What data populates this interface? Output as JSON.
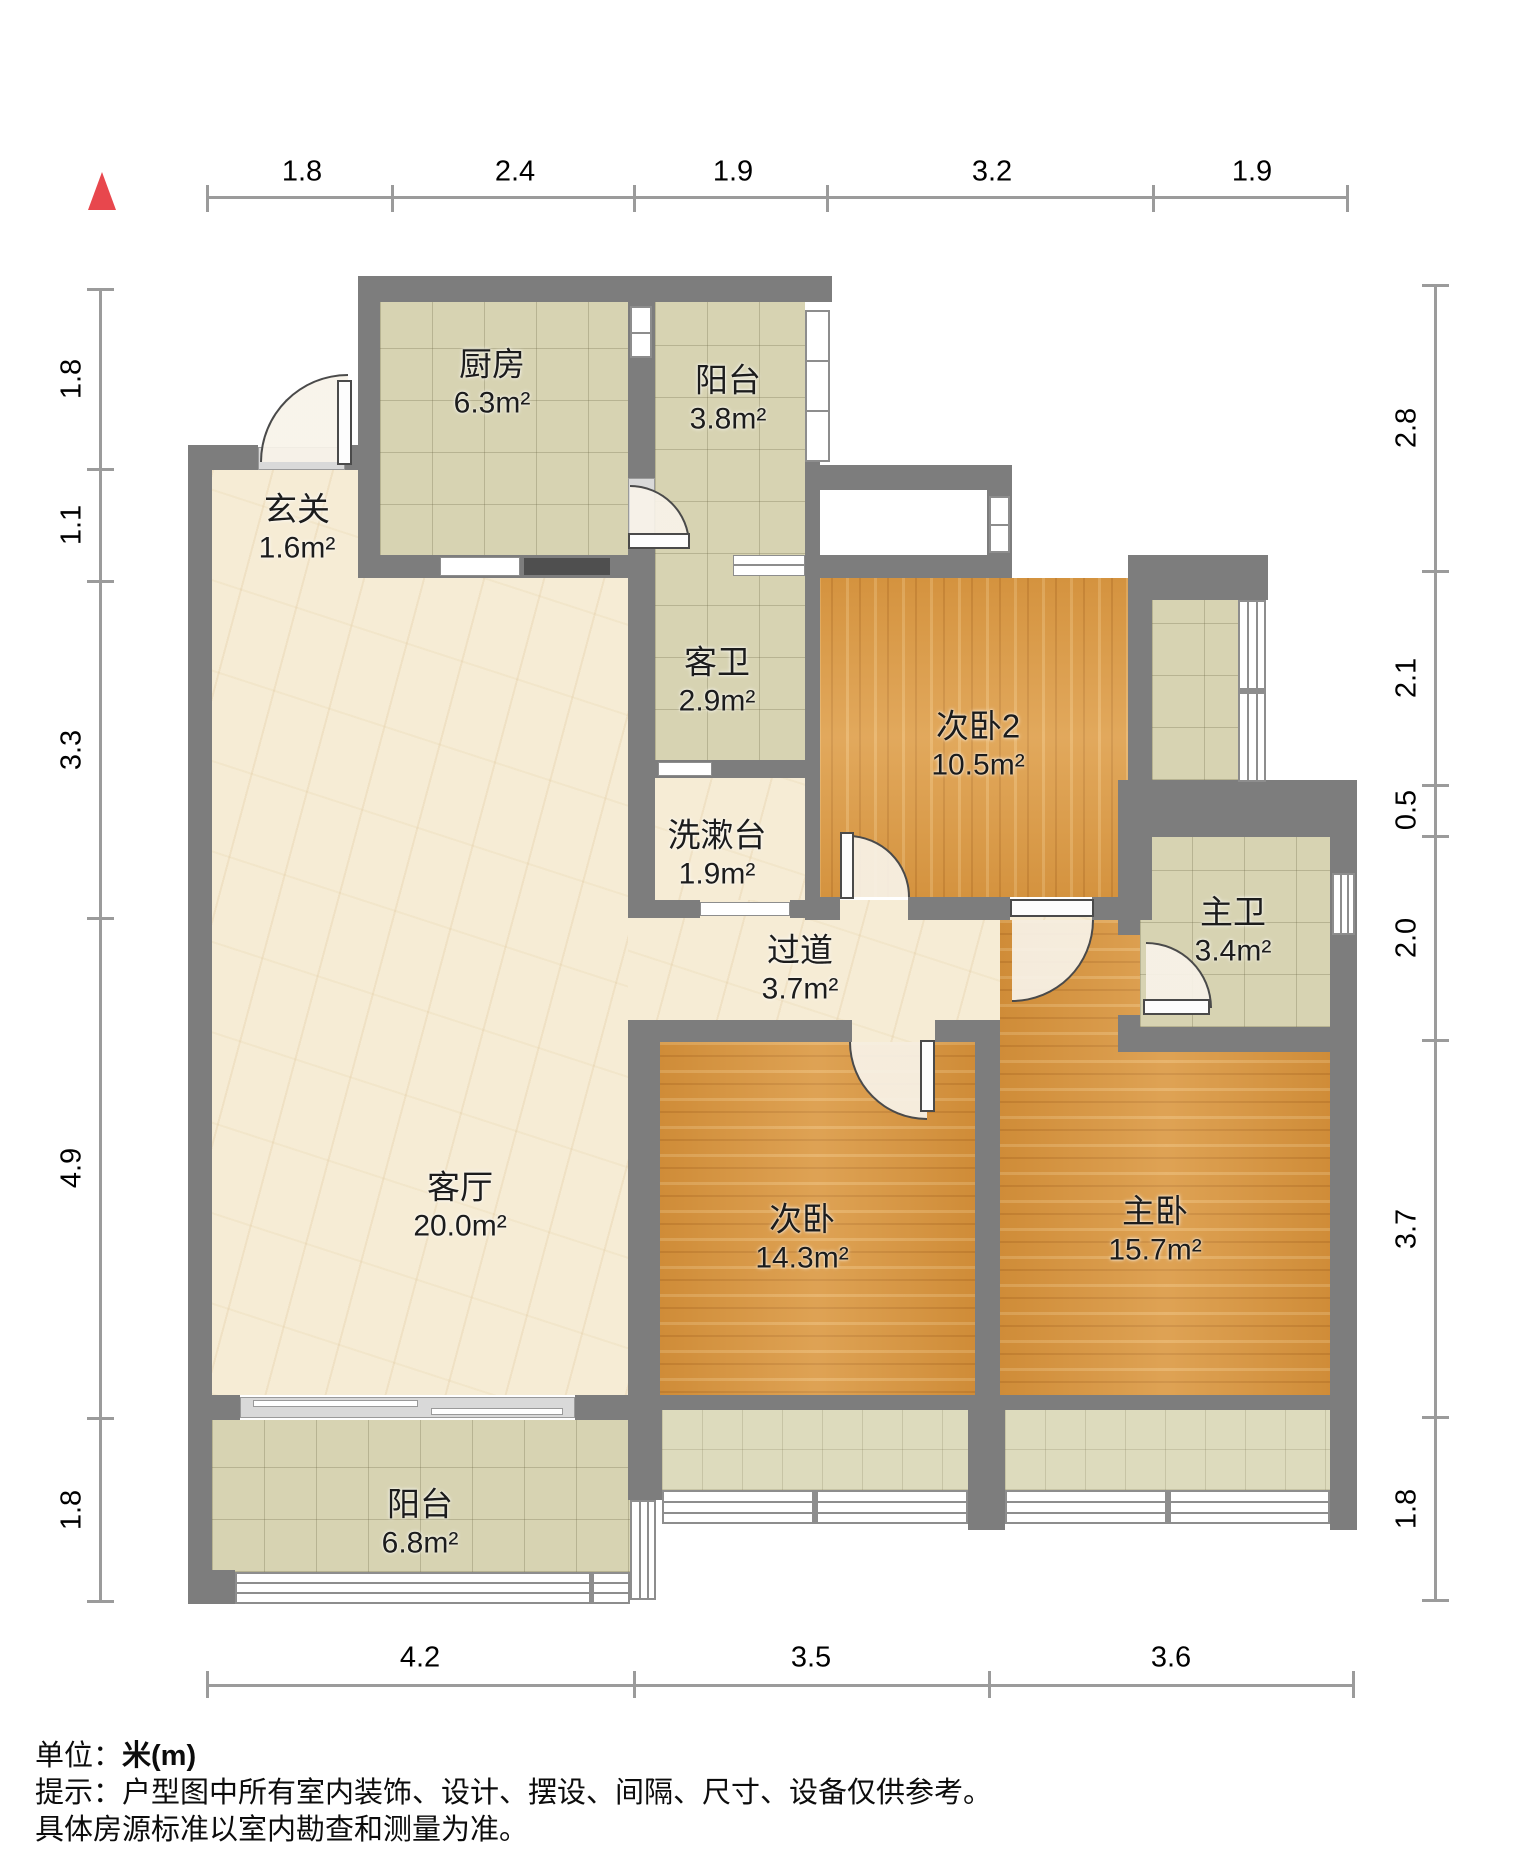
{
  "meta": {
    "type": "apartment-floor-plan",
    "wall_color": "#7d7d7d",
    "north_icon": "north-triangle",
    "north_color": "#e8474d"
  },
  "rooms": [
    {
      "name": "厨房",
      "area": "6.3m²"
    },
    {
      "name": "阳台",
      "area": "3.8m²"
    },
    {
      "name": "玄关",
      "area": "1.6m²"
    },
    {
      "name": "客卫",
      "area": "2.9m²"
    },
    {
      "name": "次卧2",
      "area": "10.5m²"
    },
    {
      "name": "洗漱台",
      "area": "1.9m²"
    },
    {
      "name": "过道",
      "area": "3.7m²"
    },
    {
      "name": "主卫",
      "area": "3.4m²"
    },
    {
      "name": "客厅",
      "area": "20.0m²"
    },
    {
      "name": "次卧",
      "area": "14.3m²"
    },
    {
      "name": "主卧",
      "area": "15.7m²"
    },
    {
      "name": "阳台",
      "area": "6.8m²"
    }
  ],
  "dims": {
    "top": [
      "1.8",
      "2.4",
      "1.9",
      "3.2",
      "1.9"
    ],
    "left": [
      "1.8",
      "1.1",
      "3.3",
      "4.9",
      "1.8"
    ],
    "right": [
      "2.8",
      "2.1",
      "0.5",
      "2.0",
      "3.7",
      "1.8"
    ],
    "bottom": [
      "4.2",
      "3.5",
      "3.6"
    ]
  },
  "footer": {
    "unit_label": "单位：",
    "unit_value": "米(m)",
    "note_line1": "提示：户型图中所有室内装饰、设计、摆设、间隔、尺寸、设备仅供参考。",
    "note_line2": "具体房源标准以室内勘查和测量为准。"
  }
}
